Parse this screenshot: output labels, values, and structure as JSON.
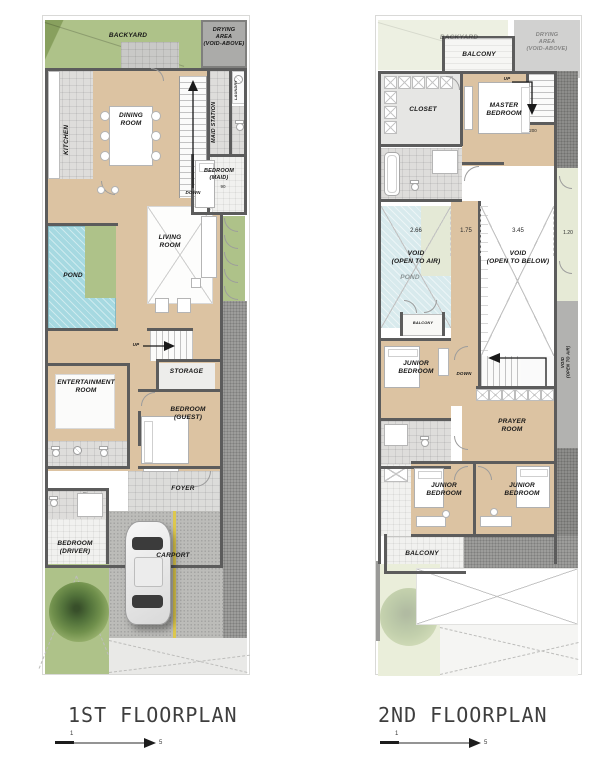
{
  "titles": {
    "plan1": "1ST FLOORPLAN",
    "plan2": "2ND FLOORPLAN"
  },
  "scalebar": {
    "start_value": "1",
    "end_value": "5"
  },
  "colors": {
    "wall": "#5c5c5c",
    "wood": "#dcc3a2",
    "tile": "#dedddb",
    "green": "#aec289",
    "green2": "#88a05e",
    "palegreen": "#e6ead6",
    "pond": "#a6d9e1",
    "pond2": "#d8eaed",
    "gravel": "#9d9d9b",
    "gravel2": "#8d8d8b",
    "paver": "#bcbcb9",
    "road": "#a6a6a4",
    "concrete": "#c9c9c7",
    "yellow": "#ddc84e",
    "title": "#3e3e3e",
    "ink": "#161616",
    "fadegray": "#ababa9"
  },
  "p1": {
    "backyard": "BACKYARD",
    "drying": "DRYING\nAREA\n(VOID-ABOVE)",
    "kitchen": "KITCHEN",
    "dining": "DINING\nROOM",
    "maid_station": "MAID STATION",
    "laundry": "LAUNDRY",
    "maid_bedroom": "BEDROOM\n(MAID)",
    "maid_bedroom_dim": "90",
    "stairs_down": "DOWN",
    "pond": "POND",
    "living": "LIVING\nROOM",
    "stairs_up": "UP",
    "storage": "STORAGE",
    "entertainment": "ENTERTAINMENT\nROOM",
    "guest_bedroom": "BEDROOM\n(GUEST)",
    "foyer": "FOYER",
    "driver_bedroom": "BEDROOM\n(DRIVER)",
    "carport": "CARPORT"
  },
  "p2": {
    "backyard": "BACKYARD",
    "balcony_top": "BALCONY",
    "drying": "DRYING\nAREA\n(VOID-ABOVE)",
    "closet": "CLOSET",
    "master_bedroom": "MASTER\nBEDROOM",
    "stairs_up": "UP",
    "bed_dim": "200",
    "dims": [
      "2.66",
      "1.75",
      "3.45",
      "1.20"
    ],
    "void_air": "VOID\n(OPEN TO AIR)",
    "pond": "POND",
    "void_below": "VOID\n(OPEN TO BELOW)",
    "balcony_mid": "BALCONY",
    "junior_bedroom_left": "JUNIOR\nBEDROOM",
    "stairs_down": "DOWN",
    "void_air_side": "VOID\n(OPEN TO AIR)",
    "prayer": "PRAYER\nROOM",
    "junior_bedroom_bl": "JUNIOR\nBEDROOM",
    "junior_bedroom_br": "JUNIOR\nBEDROOM",
    "balcony_bottom": "BALCONY"
  }
}
